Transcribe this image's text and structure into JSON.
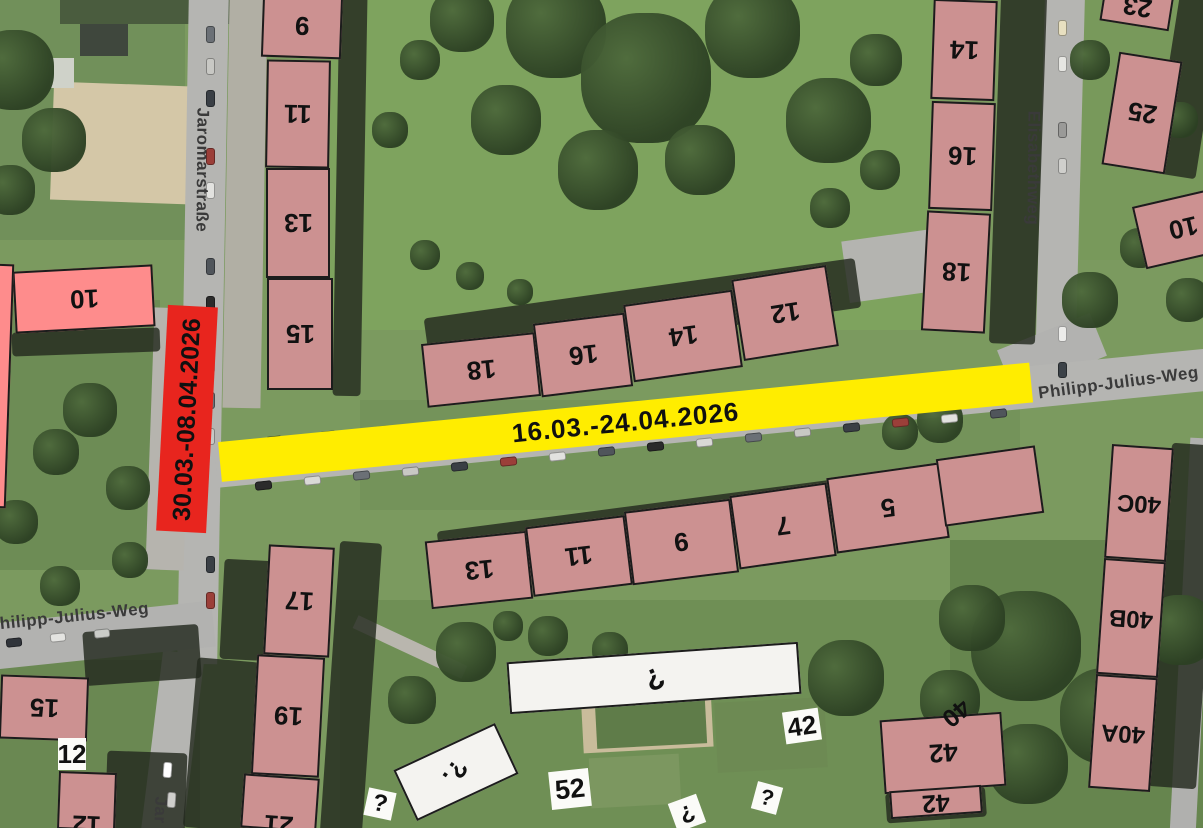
{
  "closures": {
    "red": {
      "dates": "30.03.-08.04.2026",
      "color": "#e8251e",
      "street": "Jaromarstraße"
    },
    "yellow": {
      "dates": "16.03.-24.04.2026",
      "color": "#ffed00",
      "street": "Philipp-Julius-Weg"
    }
  },
  "streets": {
    "jaromar": "Jaromarstraße",
    "jaromar_partial": "Jar",
    "elisabeth": "Elisabethweg",
    "pjw": "Philipp-Julius-Weg"
  },
  "colors": {
    "building": "#cc9191",
    "building_bright": "#fe8c8c",
    "building_white": "#f4f3f0",
    "outline": "#1c1c1c"
  },
  "buildings": [
    {
      "n": "9",
      "x": 262,
      "y": -6,
      "w": 80,
      "h": 64,
      "rot": 2,
      "c": "m"
    },
    {
      "n": "11",
      "x": 266,
      "y": 60,
      "w": 64,
      "h": 108,
      "rot": 1,
      "c": "m"
    },
    {
      "n": "13",
      "x": 266,
      "y": 168,
      "w": 64,
      "h": 110,
      "rot": 0,
      "c": "m"
    },
    {
      "n": "15",
      "x": 267,
      "y": 278,
      "w": 66,
      "h": 112,
      "rot": 0,
      "c": "m"
    },
    {
      "n": "18",
      "x": 424,
      "y": 338,
      "w": 114,
      "h": 64,
      "rot": -6,
      "c": "m"
    },
    {
      "n": "16",
      "x": 537,
      "y": 318,
      "w": 92,
      "h": 74,
      "rot": -7,
      "c": "m"
    },
    {
      "n": "14",
      "x": 628,
      "y": 297,
      "w": 110,
      "h": 78,
      "rot": -8,
      "c": "m"
    },
    {
      "n": "12",
      "x": 737,
      "y": 272,
      "w": 96,
      "h": 82,
      "rot": -9,
      "c": "m"
    },
    {
      "n": "14",
      "x": 932,
      "y": 0,
      "w": 64,
      "h": 100,
      "rot": 2,
      "c": "m"
    },
    {
      "n": "16",
      "x": 930,
      "y": 102,
      "w": 64,
      "h": 108,
      "rot": 2,
      "c": "m"
    },
    {
      "n": "18",
      "x": 924,
      "y": 212,
      "w": 64,
      "h": 120,
      "rot": 3,
      "c": "m"
    },
    {
      "n": "23",
      "x": 1102,
      "y": -12,
      "w": 70,
      "h": 38,
      "rot": 9,
      "c": "m"
    },
    {
      "n": "25",
      "x": 1110,
      "y": 56,
      "w": 64,
      "h": 114,
      "rot": 9,
      "c": "m"
    },
    {
      "n": "10",
      "x": 1138,
      "y": 196,
      "w": 90,
      "h": 64,
      "rot": -13,
      "c": "m"
    },
    {
      "n": "13",
      "x": 428,
      "y": 536,
      "w": 102,
      "h": 68,
      "rot": -6,
      "c": "m"
    },
    {
      "n": "11",
      "x": 529,
      "y": 521,
      "w": 100,
      "h": 70,
      "rot": -7,
      "c": "m"
    },
    {
      "n": "9",
      "x": 628,
      "y": 505,
      "w": 107,
      "h": 74,
      "rot": -7,
      "c": "m"
    },
    {
      "n": "7",
      "x": 734,
      "y": 489,
      "w": 98,
      "h": 74,
      "rot": -8,
      "c": "m"
    },
    {
      "n": "5",
      "x": 831,
      "y": 470,
      "w": 114,
      "h": 76,
      "rot": -8,
      "c": "m"
    },
    {
      "n": "",
      "x": 940,
      "y": 452,
      "w": 100,
      "h": 68,
      "rot": -8,
      "c": "m"
    },
    {
      "n": "40C",
      "x": 1108,
      "y": 446,
      "w": 62,
      "h": 114,
      "rot": 4,
      "c": "m",
      "fs": 24
    },
    {
      "n": "40B",
      "x": 1100,
      "y": 560,
      "w": 62,
      "h": 116,
      "rot": 4,
      "c": "m",
      "fs": 24
    },
    {
      "n": "40A",
      "x": 1092,
      "y": 676,
      "w": 62,
      "h": 114,
      "rot": 4,
      "c": "m",
      "fs": 24
    },
    {
      "n": "17",
      "x": 266,
      "y": 546,
      "w": 66,
      "h": 110,
      "rot": 3,
      "c": "m"
    },
    {
      "n": "19",
      "x": 254,
      "y": 656,
      "w": 68,
      "h": 120,
      "rot": 3,
      "c": "m"
    },
    {
      "n": "21",
      "x": 242,
      "y": 776,
      "w": 76,
      "h": 54,
      "rot": 4,
      "c": "m",
      "ly": 22
    },
    {
      "n": "15",
      "x": 0,
      "y": 676,
      "w": 88,
      "h": 64,
      "rot": 2,
      "c": "m"
    },
    {
      "n": "12",
      "x": 58,
      "y": 772,
      "w": 58,
      "h": 58,
      "rot": 2,
      "c": "m",
      "ly": 24
    },
    {
      "n": "10",
      "x": 14,
      "y": 268,
      "w": 140,
      "h": 62,
      "rot": -3,
      "c": "p"
    },
    {
      "n": "",
      "x": -10,
      "y": 264,
      "w": 20,
      "h": 244,
      "rot": 2,
      "c": "p"
    },
    {
      "n": "42",
      "x": 882,
      "y": 716,
      "w": 122,
      "h": 74,
      "rot": -4,
      "c": "m"
    },
    {
      "n": "42",
      "x": 890,
      "y": 788,
      "w": 92,
      "h": 28,
      "rot": -4,
      "c": "m",
      "fs": 25
    },
    {
      "n": "?",
      "x": 508,
      "y": 652,
      "w": 292,
      "h": 52,
      "rot": -4,
      "c": "w",
      "lr": 160,
      "fs": 30
    },
    {
      "n": "?.",
      "x": 400,
      "y": 744,
      "w": 112,
      "h": 56,
      "rot": -25,
      "c": "w",
      "lr": 150,
      "fs": 26
    }
  ],
  "boxlabels": [
    {
      "t": "12",
      "x": 58,
      "y": 738,
      "w": 28,
      "h": 32,
      "rot": 0,
      "fs": 26
    },
    {
      "t": "52",
      "x": 550,
      "y": 770,
      "w": 40,
      "h": 38,
      "rot": -6,
      "fs": 27
    },
    {
      "t": "42",
      "x": 784,
      "y": 710,
      "w": 36,
      "h": 32,
      "rot": -8,
      "fs": 26
    },
    {
      "t": "?",
      "x": 366,
      "y": 790,
      "w": 28,
      "h": 28,
      "rot": 12,
      "fs": 24
    },
    {
      "t": "?",
      "x": 672,
      "y": 798,
      "w": 30,
      "h": 30,
      "rot": 160,
      "fs": 24
    },
    {
      "t": "?",
      "x": 754,
      "y": 784,
      "w": 26,
      "h": 28,
      "rot": 15,
      "fs": 22
    },
    {
      "t": "40",
      "x": 938,
      "y": 698,
      "w": 36,
      "h": 30,
      "rot": 140,
      "fs": 25,
      "transparent": true
    }
  ]
}
